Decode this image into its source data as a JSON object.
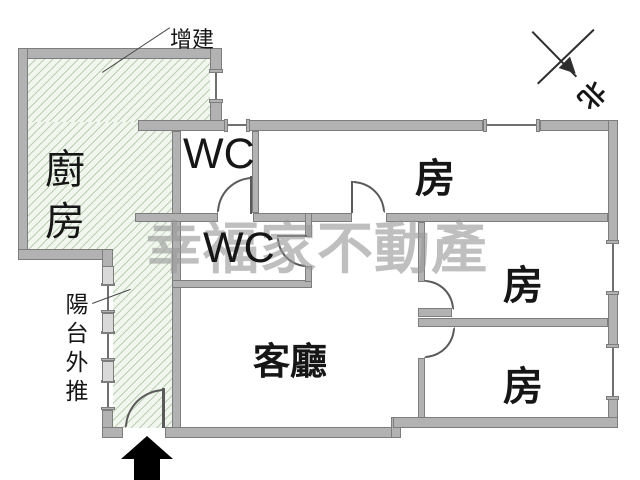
{
  "plan": {
    "type": "apartment-floor-plan",
    "labels": {
      "kitchen": "廚房",
      "addition": "增建",
      "wc_upper": "WC",
      "wc_lower": "WC",
      "living_room": "客廳",
      "room_top": "房",
      "room_middle": "房",
      "room_bottom": "房",
      "balcony_pushed_out": "陽台外推",
      "north": "北"
    },
    "watermark": "幸福家不動產",
    "colors": {
      "wall": "#b2b2b2",
      "wall_outline": "#7d7d7d",
      "hatch_fill": "#f1f6ee",
      "hatch_line": "#bccfb6",
      "text": "#161616",
      "watermark": "#989898",
      "entry_arrow": "#000000"
    }
  }
}
